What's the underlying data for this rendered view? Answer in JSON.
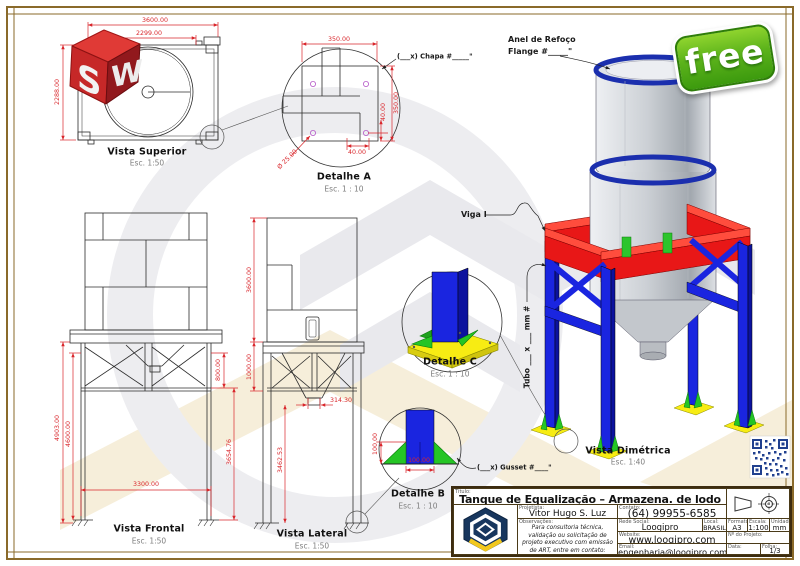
{
  "views": {
    "superior": {
      "title": "Vista Superior",
      "scale": "Esc. 1:50",
      "dim_width": "3600.00",
      "dim_inner": "2299.00",
      "dim_depth": "2288.00"
    },
    "detalhe_a": {
      "title": "Detalhe A",
      "scale": "Esc. 1 : 10",
      "dim_w": "350.00",
      "dim_h": "350.00",
      "dim_ox": "40.00",
      "dim_oy": "40.00",
      "dim_hole": "Ø 25.00",
      "callout": "(___x) Chapa #_____\""
    },
    "frontal": {
      "title": "Vista Frontal",
      "scale": "Esc. 1:50",
      "dim_total": "4903.00",
      "dim_leg": "4600.00",
      "dim_clear": "3654.76",
      "dim_span": "3300.00",
      "dim_truss": "800.00"
    },
    "lateral": {
      "title": "Vista Lateral",
      "scale": "Esc. 1:50",
      "dim_tank": "3600.00",
      "dim_truss": "1000.00",
      "dim_outlet": "314.30",
      "dim_clear": "3462.53"
    },
    "detalhe_b": {
      "title": "Detalhe B",
      "scale": "Esc. 1 : 10",
      "dim_h": "100.00",
      "dim_w": "100.00",
      "callout": "(___x) Gusset #____\""
    },
    "detalhe_c": {
      "title": "Detalhe C",
      "scale": "Esc. 1 : 10"
    },
    "dimetrica": {
      "title": "Vista Dimétrica",
      "scale": "Esc. 1:40",
      "label_viga": "Viga I",
      "label_tubo": "Tubo ___ x ___ mm #",
      "label_anel_1": "Anel de Refoço",
      "label_anel_2": "Flange #_____\""
    }
  },
  "badges": {
    "free": "free",
    "solidworks_s": "S",
    "solidworks_w": "W"
  },
  "colors": {
    "dim_red": "#d9262b",
    "structure_blue": "#1a25e0",
    "beam_red": "#e81717",
    "plate_yellow": "#f7ec13",
    "gusset_green": "#25c525",
    "frame_brown": "#8a6a2a"
  },
  "title_block": {
    "title_label": "Título:",
    "title": "Tanque de Equalização – Armazena. de lodo",
    "projetista_label": "Projetista:",
    "projetista": "Vitor Hugo S. Luz",
    "contato_label": "Contato:",
    "contato": "(64) 99955-6585",
    "observacoes_label": "Observações:",
    "observacoes": "Para consultoria técnica, validação ou solicitação de projeto executivo com emissão de ART, entre em contato:",
    "rede_label": "Rede Social:",
    "rede": "Loogipro",
    "pais_label": "Local:",
    "pais": "BRASIL",
    "formato_label": "Formato:",
    "formato": "A3",
    "escala_label": "Escala:",
    "escala": "1:100",
    "unidade_label": "Unidade:",
    "unidade": "mm",
    "website_label": "Website:",
    "website": "www.loogipro.com",
    "projeto_label": "Nº do Projeto:",
    "email_label": "Email:",
    "email": "engenharia@loogipro.com",
    "data_label": "Data:",
    "folha_label": "Folha:",
    "folha": "1/3"
  }
}
